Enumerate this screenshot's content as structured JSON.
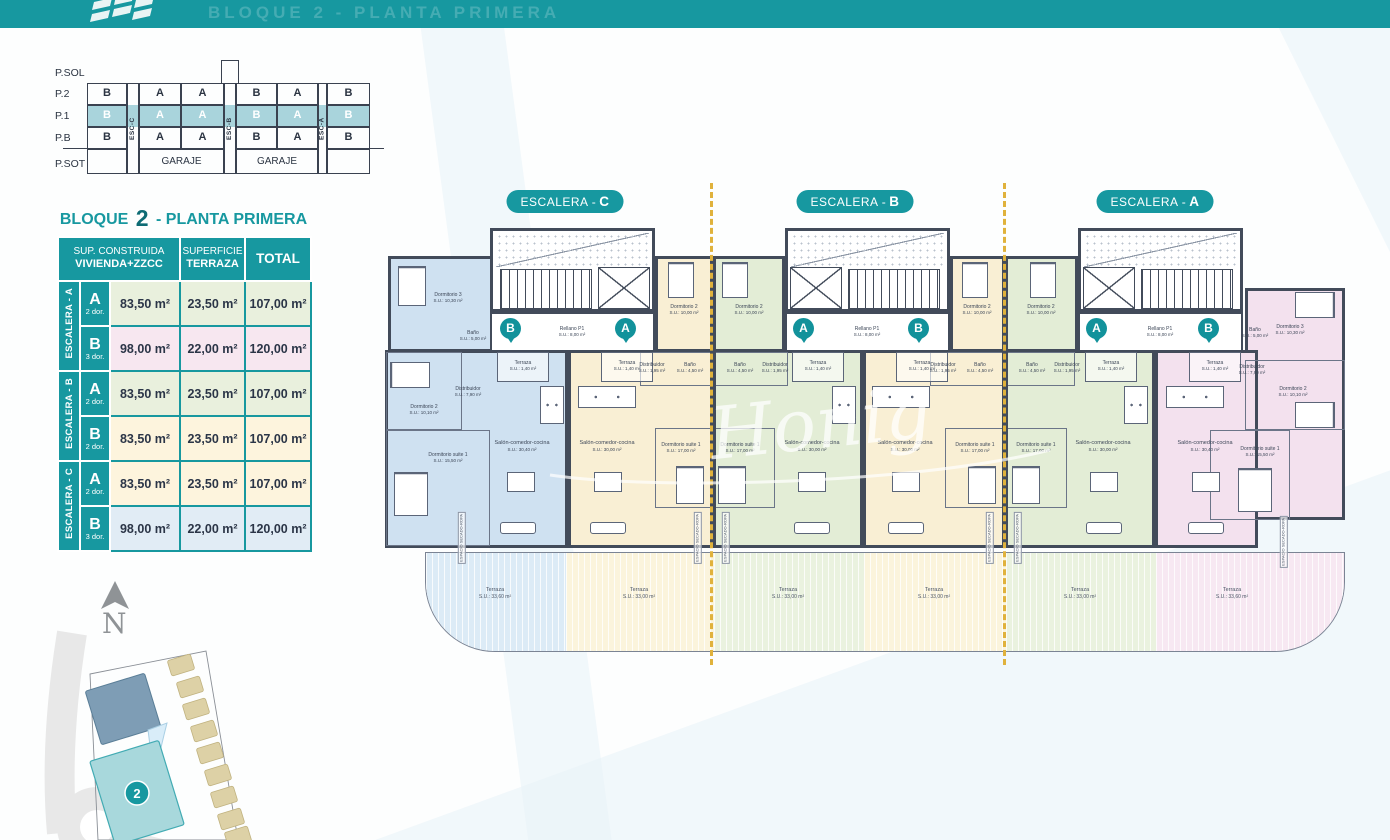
{
  "header": {
    "ghost_title": "BLOQUE 2 - PLANTA PRIMERA"
  },
  "section_diagram": {
    "floors": [
      "P.SOL",
      "P.2",
      "P.1",
      "P.B",
      "P.SOT"
    ],
    "p2": [
      "B",
      "A",
      "A",
      "B",
      "A",
      "B"
    ],
    "p1": [
      "B",
      "A",
      "A",
      "B",
      "A",
      "B"
    ],
    "pb": [
      "B",
      "A",
      "A",
      "B",
      "A",
      "B"
    ],
    "esc": [
      "ESC-C",
      "ESC-B",
      "ESC-A"
    ],
    "garage_left": "GARAJE",
    "garage_right": "GARAJE"
  },
  "summary_table": {
    "title_prefix": "BLOQUE",
    "title_number": "2",
    "title_suffix": "- PLANTA PRIMERA",
    "header": {
      "c1_line1": "SUP. CONSTRUIDA",
      "c1_line2": "VIVIENDA+ZZCC",
      "c2_line1": "SUPERFICIE",
      "c2_line2": "TERRAZA",
      "c3": "TOTAL"
    },
    "groups": [
      {
        "label": "ESCALERA - A",
        "rows": [
          {
            "unit": "A",
            "dorms": "2 dor.",
            "built": "83,50 m²",
            "terrace": "23,50 m²",
            "total": "107,00 m²"
          },
          {
            "unit": "B",
            "dorms": "3 dor.",
            "built": "98,00 m²",
            "terrace": "22,00 m²",
            "total": "120,00 m²"
          }
        ]
      },
      {
        "label": "ESCALERA - B",
        "rows": [
          {
            "unit": "A",
            "dorms": "2 dor.",
            "built": "83,50 m²",
            "terrace": "23,50 m²",
            "total": "107,00 m²"
          },
          {
            "unit": "B",
            "dorms": "2 dor.",
            "built": "83,50 m²",
            "terrace": "23,50 m²",
            "total": "107,00 m²"
          }
        ]
      },
      {
        "label": "ESCALERA - C",
        "rows": [
          {
            "unit": "A",
            "dorms": "2 dor.",
            "built": "83,50 m²",
            "terrace": "23,50 m²",
            "total": "107,00 m²"
          },
          {
            "unit": "B",
            "dorms": "3 dor.",
            "built": "98,00 m²",
            "terrace": "22,00 m²",
            "total": "120,00 m²"
          }
        ]
      }
    ],
    "row_colors": [
      "#e9f0dd",
      "#f7e7f0",
      "#e9f0dd",
      "#fdf4dd",
      "#fdf4dd",
      "#e1ecf5"
    ]
  },
  "plan": {
    "badges": [
      {
        "text": "ESCALERA -",
        "letter": "C"
      },
      {
        "text": "ESCALERA -",
        "letter": "B"
      },
      {
        "text": "ESCALERA -",
        "letter": "A"
      }
    ],
    "pins": [
      "B",
      "A",
      "A",
      "B",
      "A",
      "B"
    ],
    "rellano": {
      "name": "Rellano P1",
      "area": "S.U.: 8,00 m²"
    },
    "small_terrace": {
      "name": "Terraza",
      "area": "S.U.: 1,40 m²"
    },
    "secado": "ESPACIO SECADO-ROPA",
    "units": [
      {
        "id": "escalera-c-vivienda-b",
        "color": "#cfe1f1",
        "rooms": [
          {
            "n": "Dormitorio 3",
            "a": "S.U.: 10,30 m²"
          },
          {
            "n": "Baño",
            "a": "S.U.: 5,00 m²"
          },
          {
            "n": "Distribuidor",
            "a": "S.U.: 7,90 m²"
          },
          {
            "n": "Dormitorio 2",
            "a": "S.U.: 10,10 m²"
          },
          {
            "n": "Dormitorio suite 1",
            "a": "S.U.: 15,50 m²"
          },
          {
            "n": "Salón-comedor-cocina",
            "a": "S.U.: 30,40 m²"
          }
        ]
      },
      {
        "id": "escalera-c-vivienda-a",
        "color": "#f9efd4",
        "rooms": [
          {
            "n": "Dormitorio 2",
            "a": "S.U.: 10,00 m²"
          },
          {
            "n": "Distribuidor",
            "a": "S.U.: 1,95 m²"
          },
          {
            "n": "Baño",
            "a": "S.U.: 4,50 m²"
          },
          {
            "n": "Dormitorio suite 1",
            "a": "S.U.: 17,00 m²"
          },
          {
            "n": "Salón-comedor-cocina",
            "a": "S.U.: 30,00 m²"
          }
        ]
      },
      {
        "id": "escalera-b-vivienda-a",
        "color": "#e3edd6",
        "rooms": [
          {
            "n": "Dormitorio 2",
            "a": "S.U.: 10,00 m²"
          },
          {
            "n": "Baño",
            "a": "S.U.: 4,50 m²"
          },
          {
            "n": "Distribuidor",
            "a": "S.U.: 1,95 m²"
          },
          {
            "n": "Dormitorio suite 1",
            "a": "S.U.: 17,00 m²"
          },
          {
            "n": "Salón-comedor-cocina",
            "a": "S.U.: 30,00 m²"
          }
        ]
      },
      {
        "id": "escalera-b-vivienda-b",
        "color": "#f9efd4",
        "rooms": [
          {
            "n": "Dormitorio 2",
            "a": "S.U.: 10,00 m²"
          },
          {
            "n": "Distribuidor",
            "a": "S.U.: 1,95 m²"
          },
          {
            "n": "Baño",
            "a": "S.U.: 4,50 m²"
          },
          {
            "n": "Dormitorio suite 1",
            "a": "S.U.: 17,00 m²"
          },
          {
            "n": "Salón-comedor-cocina",
            "a": "S.U.: 30,00 m²"
          }
        ]
      },
      {
        "id": "escalera-a-vivienda-a",
        "color": "#e3edd6",
        "rooms": [
          {
            "n": "Dormitorio 2",
            "a": "S.U.: 10,00 m²"
          },
          {
            "n": "Baño",
            "a": "S.U.: 4,50 m²"
          },
          {
            "n": "Distribuidor",
            "a": "S.U.: 1,95 m²"
          },
          {
            "n": "Dormitorio suite 1",
            "a": "S.U.: 17,00 m²"
          },
          {
            "n": "Salón-comedor-cocina",
            "a": "S.U.: 30,00 m²"
          }
        ]
      },
      {
        "id": "escalera-a-vivienda-b",
        "color": "#f3e1ee",
        "rooms": [
          {
            "n": "Dormitorio 3",
            "a": "S.U.: 10,30 m²"
          },
          {
            "n": "Baño",
            "a": "S.U.: 5,00 m²"
          },
          {
            "n": "Distribuidor",
            "a": "S.U.: 7,90 m²"
          },
          {
            "n": "Dormitorio 2",
            "a": "S.U.: 10,10 m²"
          },
          {
            "n": "Dormitorio suite 1",
            "a": "S.U.: 15,50 m²"
          },
          {
            "n": "Salón-comedor-cocina",
            "a": "S.U.: 30,40 m²"
          }
        ]
      }
    ],
    "terraces": [
      {
        "name": "Terraza",
        "area": "S.U.: 33,60 m²"
      },
      {
        "name": "Terraza",
        "area": "S.U.: 33,00 m²"
      },
      {
        "name": "Terraza",
        "area": "S.U.: 33,00 m²"
      },
      {
        "name": "Terraza",
        "area": "S.U.: 33,00 m²"
      },
      {
        "name": "Terraza",
        "area": "S.U.: 33,00 m²"
      },
      {
        "name": "Terraza",
        "area": "S.U.: 33,60 m²"
      }
    ]
  },
  "watermark": "Honig",
  "site_plan": {
    "north": "N",
    "block_badge": "2"
  },
  "colors": {
    "teal": "#1798a0",
    "dark_teal": "#0d6b74",
    "navy": "#2b3547",
    "wall": "#424b5a",
    "dash_yellow": "#e0b23c",
    "unit_blue": "#cfe1f1",
    "unit_cream": "#f9efd4",
    "unit_green": "#e3edd6",
    "unit_pink": "#f3e1ee",
    "p1_highlight": "#a9d4dc"
  }
}
